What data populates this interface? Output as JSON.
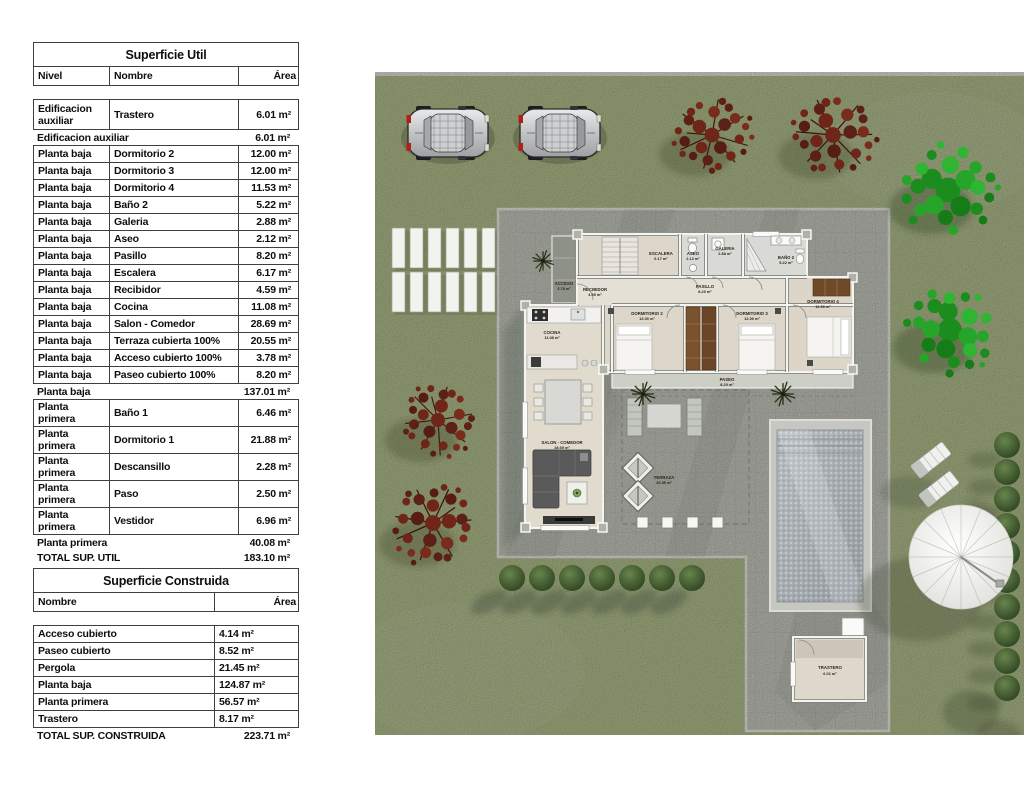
{
  "superficie_util": {
    "title": "Superficie Util",
    "headers": {
      "nivel": "Nivel",
      "nombre": "Nombre",
      "area": "Área"
    },
    "rows": [
      {
        "nivel": "Edificacion auxiliar",
        "nombre": "Trastero",
        "area": "6.01 m²"
      },
      {
        "label": "Edificacion auxiliar",
        "area": "6.01 m²"
      },
      {
        "nivel": "Planta baja",
        "nombre": "Dormitorio 2",
        "area": "12.00 m²"
      },
      {
        "nivel": "Planta baja",
        "nombre": "Dormitorio 3",
        "area": "12.00 m²"
      },
      {
        "nivel": "Planta baja",
        "nombre": "Dormitorio 4",
        "area": "11.53 m²"
      },
      {
        "nivel": "Planta baja",
        "nombre": "Baño 2",
        "area": "5.22 m²"
      },
      {
        "nivel": "Planta baja",
        "nombre": "Galeria",
        "area": "2.88 m²"
      },
      {
        "nivel": "Planta baja",
        "nombre": "Aseo",
        "area": "2.12 m²"
      },
      {
        "nivel": "Planta baja",
        "nombre": "Pasillo",
        "area": "8.20 m²"
      },
      {
        "nivel": "Planta baja",
        "nombre": "Escalera",
        "area": "6.17 m²"
      },
      {
        "nivel": "Planta baja",
        "nombre": "Recibidor",
        "area": "4.59 m²"
      },
      {
        "nivel": "Planta baja",
        "nombre": "Cocina",
        "area": "11.08 m²"
      },
      {
        "nivel": "Planta baja",
        "nombre": "Salon - Comedor",
        "area": "28.69 m²"
      },
      {
        "nivel": "Planta baja",
        "nombre": "Terraza cubierta 100%",
        "area": "20.55 m²"
      },
      {
        "nivel": "Planta baja",
        "nombre": "Acceso cubierto 100%",
        "area": "3.78 m²"
      },
      {
        "nivel": "Planta baja",
        "nombre": "Paseo cubierto 100%",
        "area": "8.20 m²"
      },
      {
        "label": "Planta baja",
        "area": "137.01 m²"
      },
      {
        "nivel": "Planta primera",
        "nombre": "Baño 1",
        "area": "6.46 m²"
      },
      {
        "nivel": "Planta primera",
        "nombre": "Dormitorio 1",
        "area": "21.88 m²"
      },
      {
        "nivel": "Planta primera",
        "nombre": "Descansillo",
        "area": "2.28 m²"
      },
      {
        "nivel": "Planta primera",
        "nombre": "Paso",
        "area": "2.50 m²"
      },
      {
        "nivel": "Planta primera",
        "nombre": "Vestidor",
        "area": "6.96 m²"
      },
      {
        "label": "Planta primera",
        "area": "40.08 m²"
      },
      {
        "label": "TOTAL SUP. UTIL",
        "area": "183.10 m²"
      }
    ]
  },
  "superficie_construida": {
    "title": "Superficie Construida",
    "headers": {
      "nombre": "Nombre",
      "area": "Área"
    },
    "rows": [
      {
        "nombre": "Acceso cubierto",
        "area": "4.14 m²"
      },
      {
        "nombre": "Paseo cubierto",
        "area": "8.52 m²"
      },
      {
        "nombre": "Pergola",
        "area": "21.45 m²"
      },
      {
        "nombre": "Planta baja",
        "area": "124.87 m²"
      },
      {
        "nombre": "Planta primera",
        "area": "56.57 m²"
      },
      {
        "nombre": "Trastero",
        "area": "8.17 m²"
      }
    ],
    "total": {
      "label": "TOTAL SUP. CONSTRUIDA",
      "area": "223.71 m²"
    }
  },
  "plan": {
    "rooms": [
      {
        "name": "ACCESO",
        "area": "3.78 m²"
      },
      {
        "name": "RECIBIDOR",
        "area": "4.59 m²"
      },
      {
        "name": "ESCALERA",
        "area": "6.17 m²"
      },
      {
        "name": "ASEO",
        "area": "2.12 m²"
      },
      {
        "name": "GALERIA",
        "area": "2.88 m²"
      },
      {
        "name": "BAÑO 2",
        "area": "5.22 m²"
      },
      {
        "name": "PASILLO",
        "area": "8.20 m²"
      },
      {
        "name": "DORMITORIO 2",
        "area": "12.00 m²"
      },
      {
        "name": "DORMITORIO 3",
        "area": "12.00 m²"
      },
      {
        "name": "DORMITORIO 4",
        "area": "11.53 m²"
      },
      {
        "name": "COCINA",
        "area": "11.08 m²"
      },
      {
        "name": "SALON - COMEDOR",
        "area": "28.69 m²"
      },
      {
        "name": "TERRAZA",
        "area": "20.55 m²"
      },
      {
        "name": "PASEO",
        "area": "8.20 m²"
      },
      {
        "name": "TRASTERO",
        "area": "6.01 m²"
      }
    ],
    "colors": {
      "grass": "#a5b283",
      "paving": "#b9bcb2",
      "pool_water": "#aab1b6",
      "tree_red": "#5d2017",
      "tree_green": "#23a126",
      "bush": "#3d5530",
      "wardrobe": "#7a5230"
    }
  }
}
